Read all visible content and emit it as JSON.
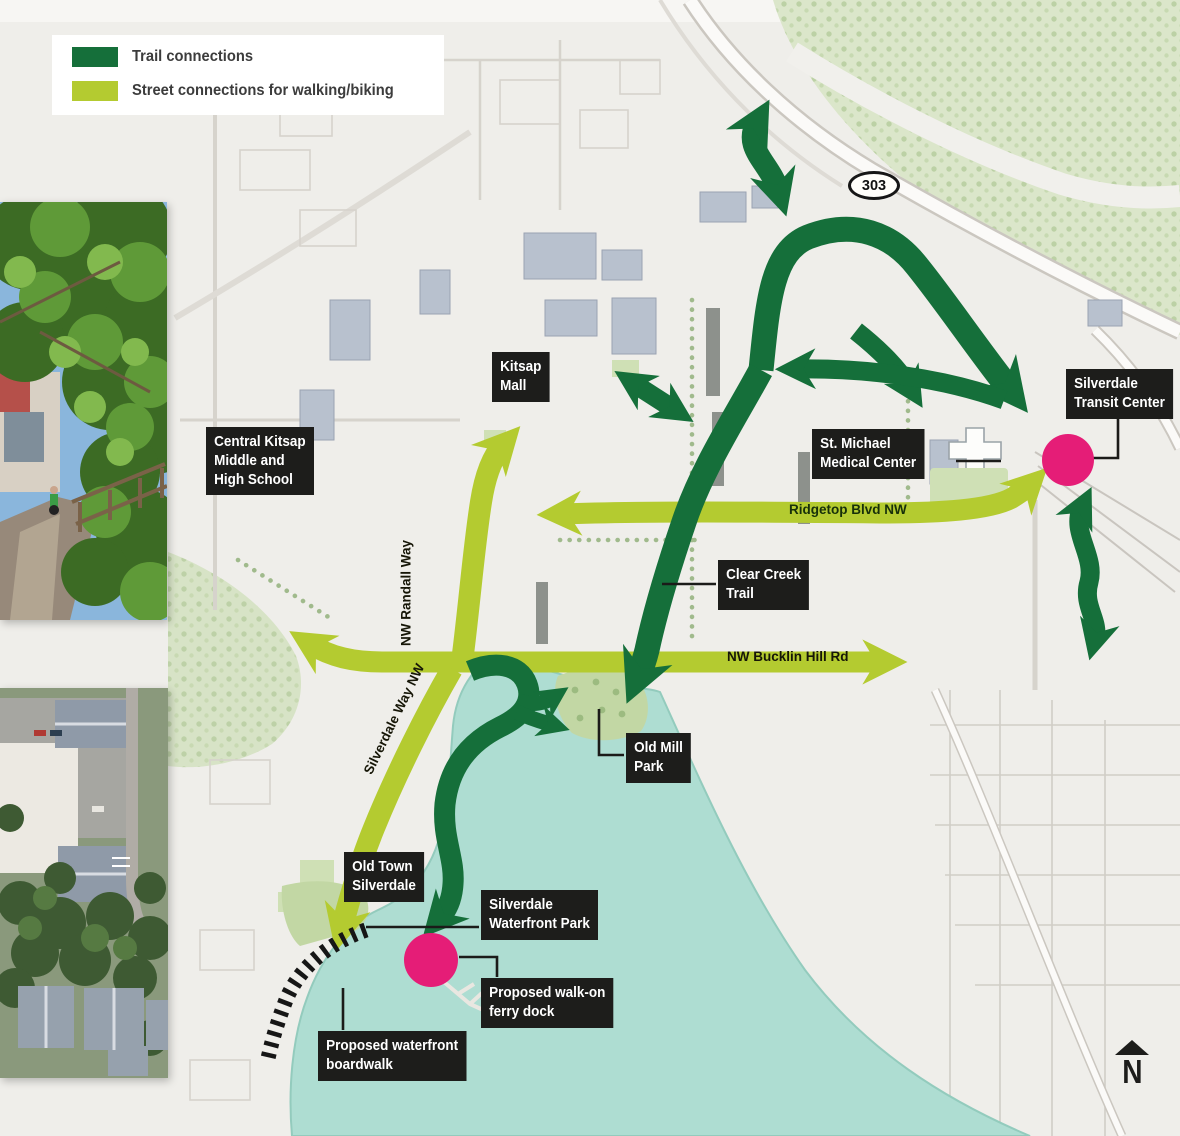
{
  "legend": {
    "items": [
      {
        "label": "Trail connections",
        "color": "#156f3a"
      },
      {
        "label": "Street connections for walking/biking",
        "color": "#b4cb30"
      }
    ]
  },
  "labels": {
    "kitsap_mall": {
      "lines": [
        "Kitsap",
        "Mall"
      ]
    },
    "central_kitsap": {
      "lines": [
        "Central Kitsap",
        "Middle and",
        "High School"
      ]
    },
    "transit_center": {
      "lines": [
        "Silverdale",
        "Transit Center"
      ]
    },
    "st_michael": {
      "lines": [
        "St. Michael",
        "Medical Center"
      ]
    },
    "clear_creek": {
      "lines": [
        "Clear Creek",
        "Trail"
      ]
    },
    "old_mill": {
      "lines": [
        "Old Mill",
        "Park"
      ]
    },
    "old_town": {
      "lines": [
        "Old Town",
        "Silverdale"
      ]
    },
    "waterfront_park": {
      "lines": [
        "Silverdale",
        "Waterfront Park"
      ]
    },
    "ferry_dock": {
      "lines": [
        "Proposed walk-on",
        "ferry dock"
      ]
    },
    "boardwalk": {
      "lines": [
        "Proposed waterfront",
        "boardwalk"
      ]
    }
  },
  "street_labels": {
    "ridgetop": "Ridgetop Blvd NW",
    "bucklin": "NW Bucklin Hill Rd",
    "randall": "NW Randall Way",
    "silverdale_way": "Silverdale Way NW"
  },
  "route_shield": {
    "number": "303"
  },
  "north_arrow": {
    "label": "N"
  },
  "colors": {
    "trail": "#156f3a",
    "street": "#b4cb30",
    "marker_dot": "#e51d77",
    "water": "#aeddd2",
    "boardwalk": "#161616",
    "label_bg": "#1d1d1b"
  }
}
